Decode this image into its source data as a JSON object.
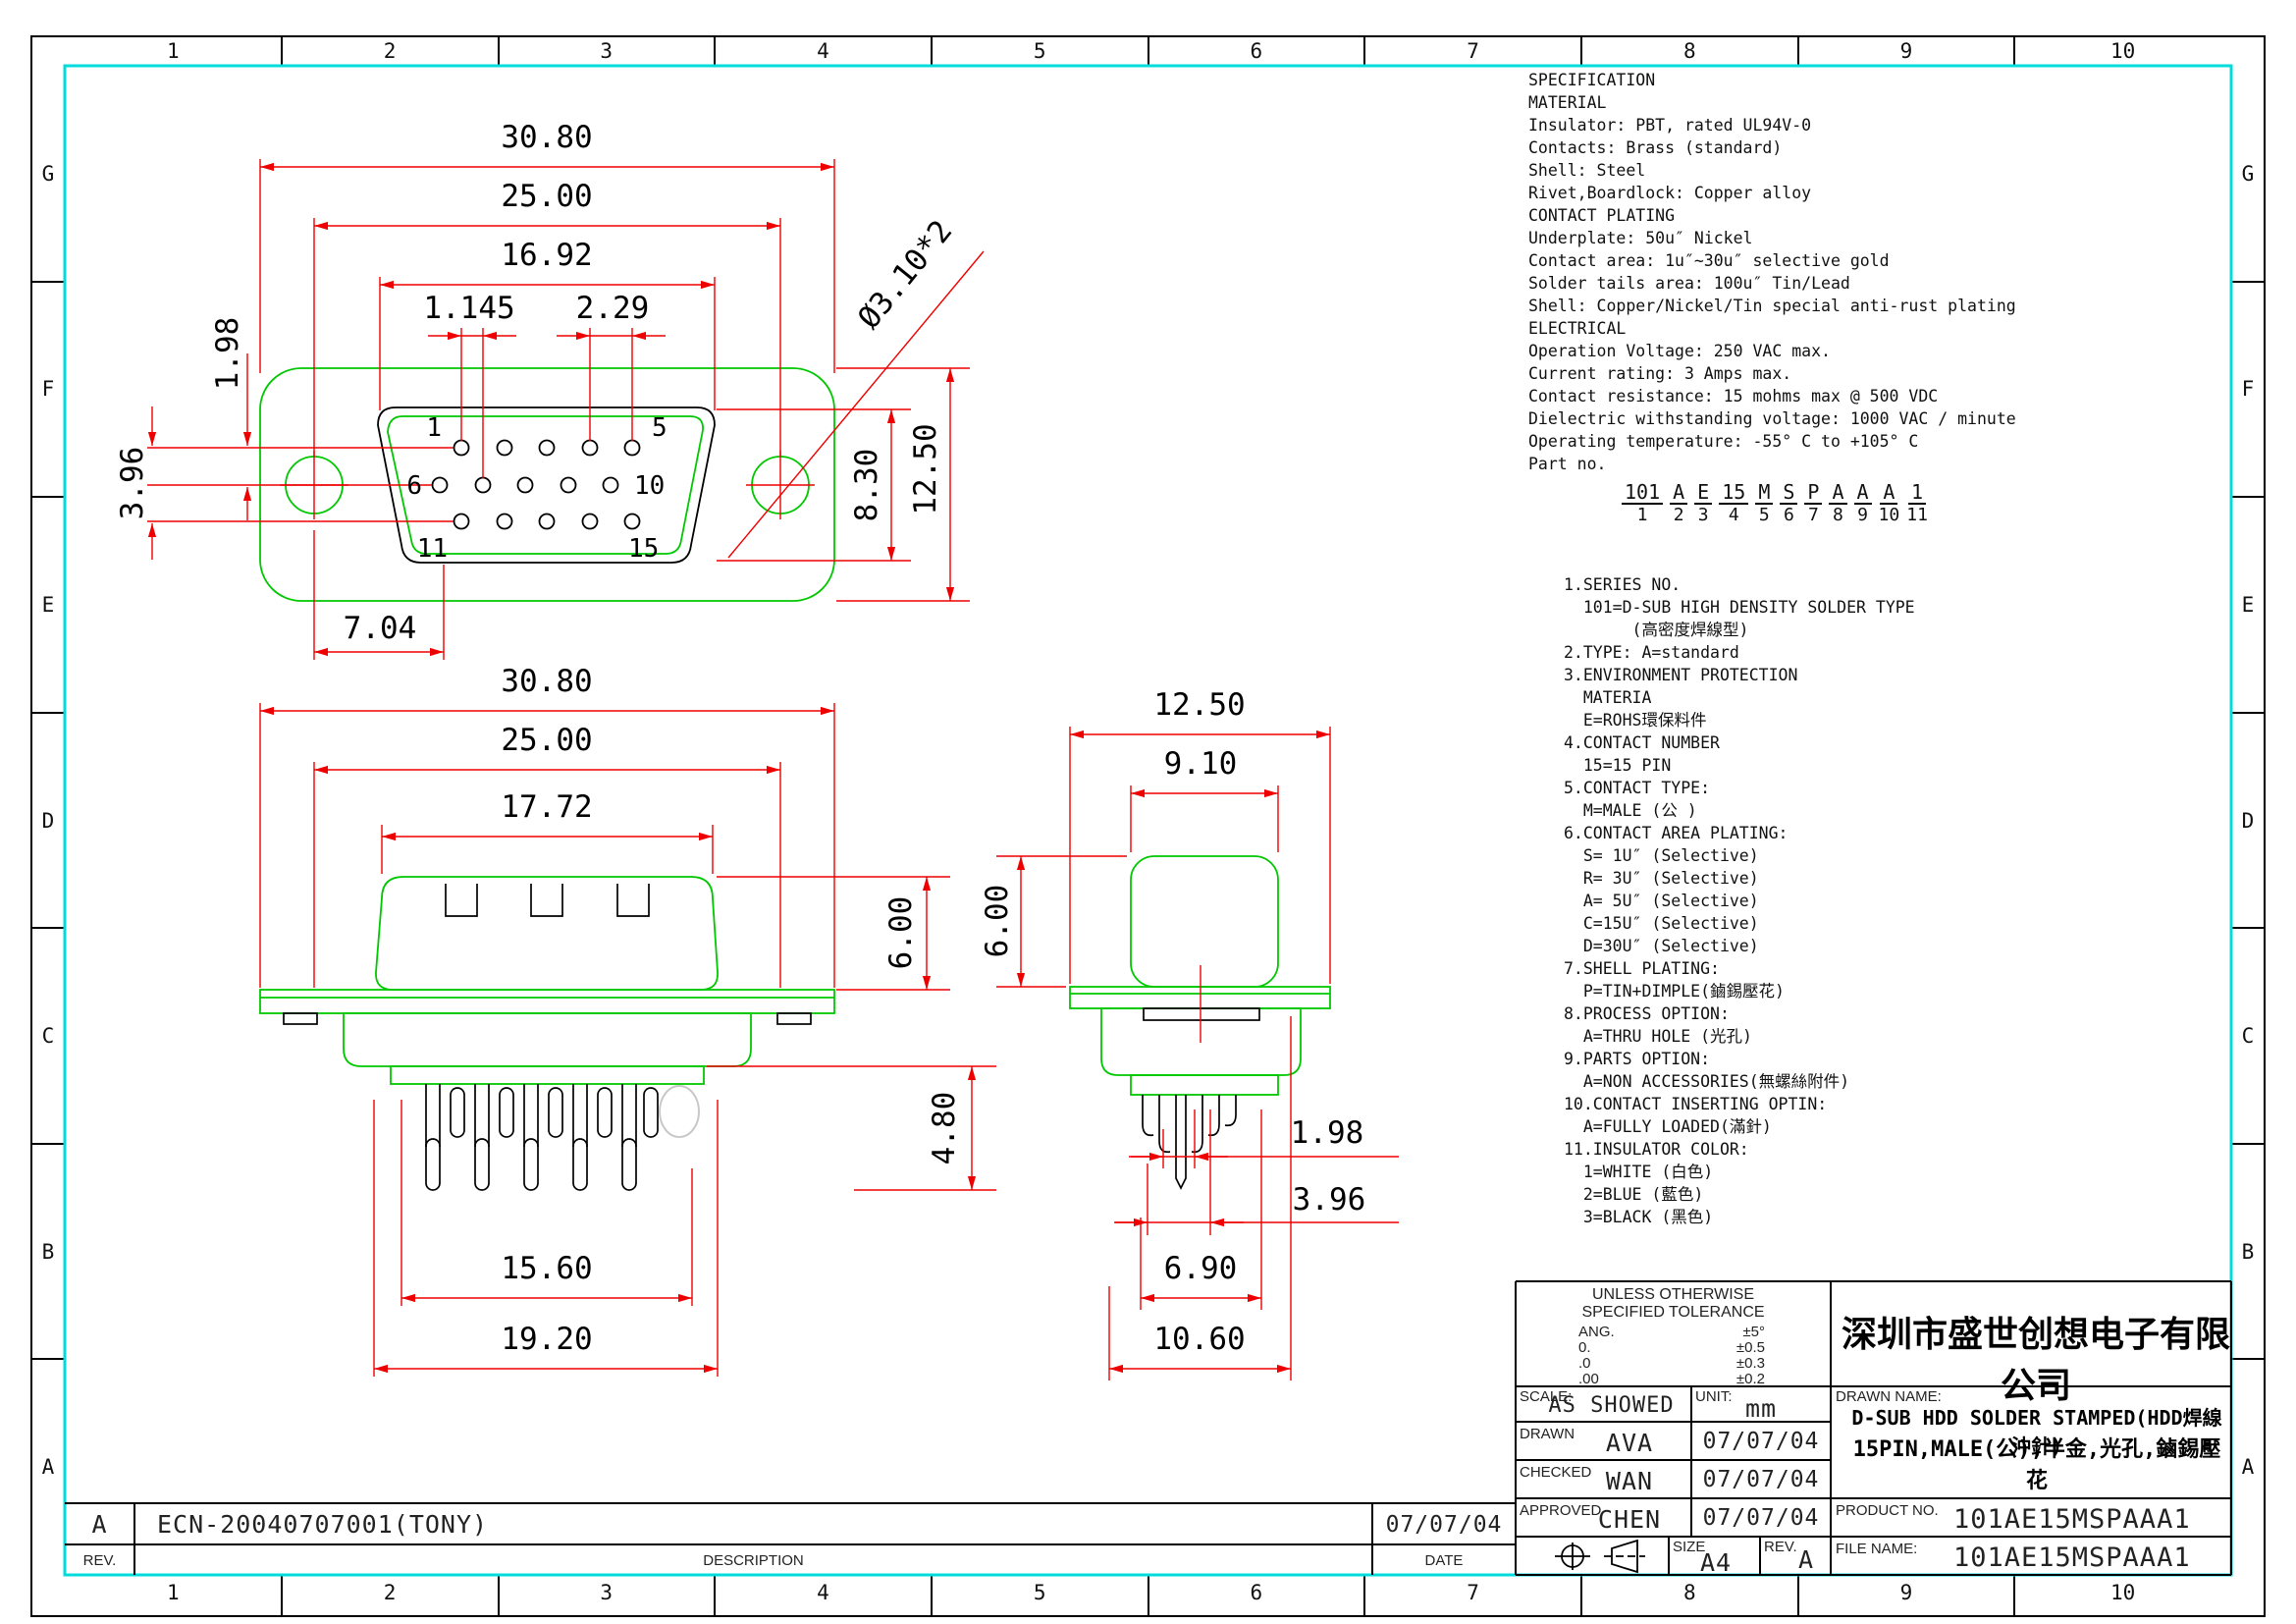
{
  "colors": {
    "dimension_red": "#ee0000",
    "body_green": "#00c800",
    "frame_cyan": "#00dcdc",
    "line_black": "#000000"
  },
  "border": {
    "cols": [
      "1",
      "2",
      "3",
      "4",
      "5",
      "6",
      "7",
      "8",
      "9",
      "10"
    ],
    "rows": [
      "G",
      "F",
      "E",
      "D",
      "C",
      "B",
      "A"
    ]
  },
  "spec": {
    "lines": [
      "SPECIFICATION",
      "MATERIAL",
      "Insulator: PBT, rated UL94V-0",
      "Contacts: Brass (standard)",
      "Shell: Steel",
      "Rivet,Boardlock: Copper alloy",
      "CONTACT PLATING",
      "Underplate: 50u″ Nickel",
      "Contact area: 1u″~30u″ selective gold",
      "Solder tails area: 100u″ Tin/Lead",
      "Shell: Copper/Nickel/Tin special anti-rust plating",
      "ELECTRICAL",
      "Operation Voltage: 250 VAC max.",
      "Current rating: 3 Amps max.",
      "Contact resistance: 15 mohms max @ 500 VDC",
      "Dielectric withstanding voltage: 1000 VAC / minute",
      "Operating temperature: -55° C to +105° C",
      "Part no."
    ],
    "part_groups": [
      {
        "g": "101",
        "n": "1"
      },
      {
        "g": "A",
        "n": "2"
      },
      {
        "g": "E",
        "n": "3"
      },
      {
        "g": "15",
        "n": "4"
      },
      {
        "g": "M",
        "n": "5"
      },
      {
        "g": "S",
        "n": "6"
      },
      {
        "g": "P",
        "n": "7"
      },
      {
        "g": "A",
        "n": "8"
      },
      {
        "g": "A",
        "n": "9"
      },
      {
        "g": "A",
        "n": "10"
      },
      {
        "g": "1",
        "n": "11"
      }
    ]
  },
  "notes_lines": [
    "1.SERIES NO.",
    "  101=D-SUB HIGH DENSITY SOLDER TYPE",
    "       (高密度焊線型)",
    "2.TYPE: A=standard",
    "3.ENVIRONMENT PROTECTION",
    "  MATERIA",
    "  E=ROHS環保料件",
    "4.CONTACT NUMBER",
    "  15=15 PIN",
    "5.CONTACT TYPE:",
    "  M=MALE (公 )",
    "6.CONTACT AREA PLATING:",
    "  S= 1U″ (Selective)",
    "  R= 3U″ (Selective)",
    "  A= 5U″ (Selective)",
    "  C=15U″ (Selective)",
    "  D=30U″ (Selective)",
    "7.SHELL PLATING:",
    "  P=TIN+DIMPLE(鏀錫壓花)",
    "8.PROCESS OPTION:",
    "  A=THRU HOLE (光孔)",
    "9.PARTS OPTION:",
    "  A=NON ACCESSORIES(無螺絲附件)",
    "10.CONTACT INSERTING OPTIN:",
    "  A=FULLY LOADED(滿針)",
    "11.INSULATOR COLOR:",
    "  1=WHITE (白色)",
    "  2=BLUE (藍色)",
    "  3=BLACK (黑色)"
  ],
  "views": {
    "front": {
      "dims": {
        "d3080": "30.80",
        "d2500": "25.00",
        "d1692": "16.92",
        "d1145": "1.145",
        "d229": "2.29",
        "dia": "Ø3.10*2",
        "d198": "1.98",
        "d396": "3.96",
        "d830": "8.30",
        "d1250": "12.50",
        "d704": "7.04"
      },
      "pins": {
        "p1": "1",
        "p5": "5",
        "p6": "6",
        "p10": "10",
        "p11": "11",
        "p15": "15"
      }
    },
    "rear": {
      "dims": {
        "d3080": "30.80",
        "d2500": "25.00",
        "d1772": "17.72",
        "d600": "6.00",
        "d480": "4.80",
        "d1560": "15.60",
        "d1920": "19.20"
      }
    },
    "side": {
      "dims": {
        "d1250": "12.50",
        "d910": "9.10",
        "d600": "6.00",
        "d198": "1.98",
        "d396": "3.96",
        "d690": "6.90",
        "d1060": "10.60"
      }
    }
  },
  "title_block": {
    "tolerance": {
      "head1": "UNLESS OTHERWISE",
      "head2": "SPECIFIED TOLERANCE",
      "rows": [
        {
          "a": "ANG.",
          "b": "±5°"
        },
        {
          "a": "0.",
          "b": "±0.5"
        },
        {
          "a": ".0",
          "b": "±0.3"
        },
        {
          "a": ".00",
          "b": "±0.2"
        }
      ]
    },
    "scale_label": "SCALE:",
    "scale_value": "AS SHOWED",
    "unit_label": "UNIT:",
    "unit_value": "mm",
    "drawn_label": "DRAWN",
    "drawn_value": "AVA",
    "drawn_date": "07/07/04",
    "checked_label": "CHECKED",
    "checked_value": "WAN",
    "checked_date": "07/07/04",
    "approved_label": "APPROVED",
    "approved_value": "CHEN",
    "approved_date": "07/07/04",
    "size_label": "SIZE",
    "size_value": "A4",
    "rev_label": "REV.",
    "rev_value": "A",
    "company": "深圳市盛世创想电子有限公司",
    "drawn_name_label": "DRAWN NAME:",
    "drawn_name_line1": "D-SUB HDD SOLDER STAMPED(HDD焊線沖針)",
    "drawn_name_line2": "15PIN,MALE(公),半金,光孔,鏀錫壓花",
    "product_no_label": "PRODUCT NO.",
    "product_no": "101AE15MSPAAA1",
    "file_name_label": "FILE NAME:",
    "file_name": "101AE15MSPAAA1"
  },
  "revision_strip": {
    "rev_value": "A",
    "description_value": "ECN-20040707001(TONY)",
    "date_value": "07/07/04",
    "rev_label": "REV.",
    "description_label": "DESCRIPTION",
    "date_label": "DATE"
  }
}
